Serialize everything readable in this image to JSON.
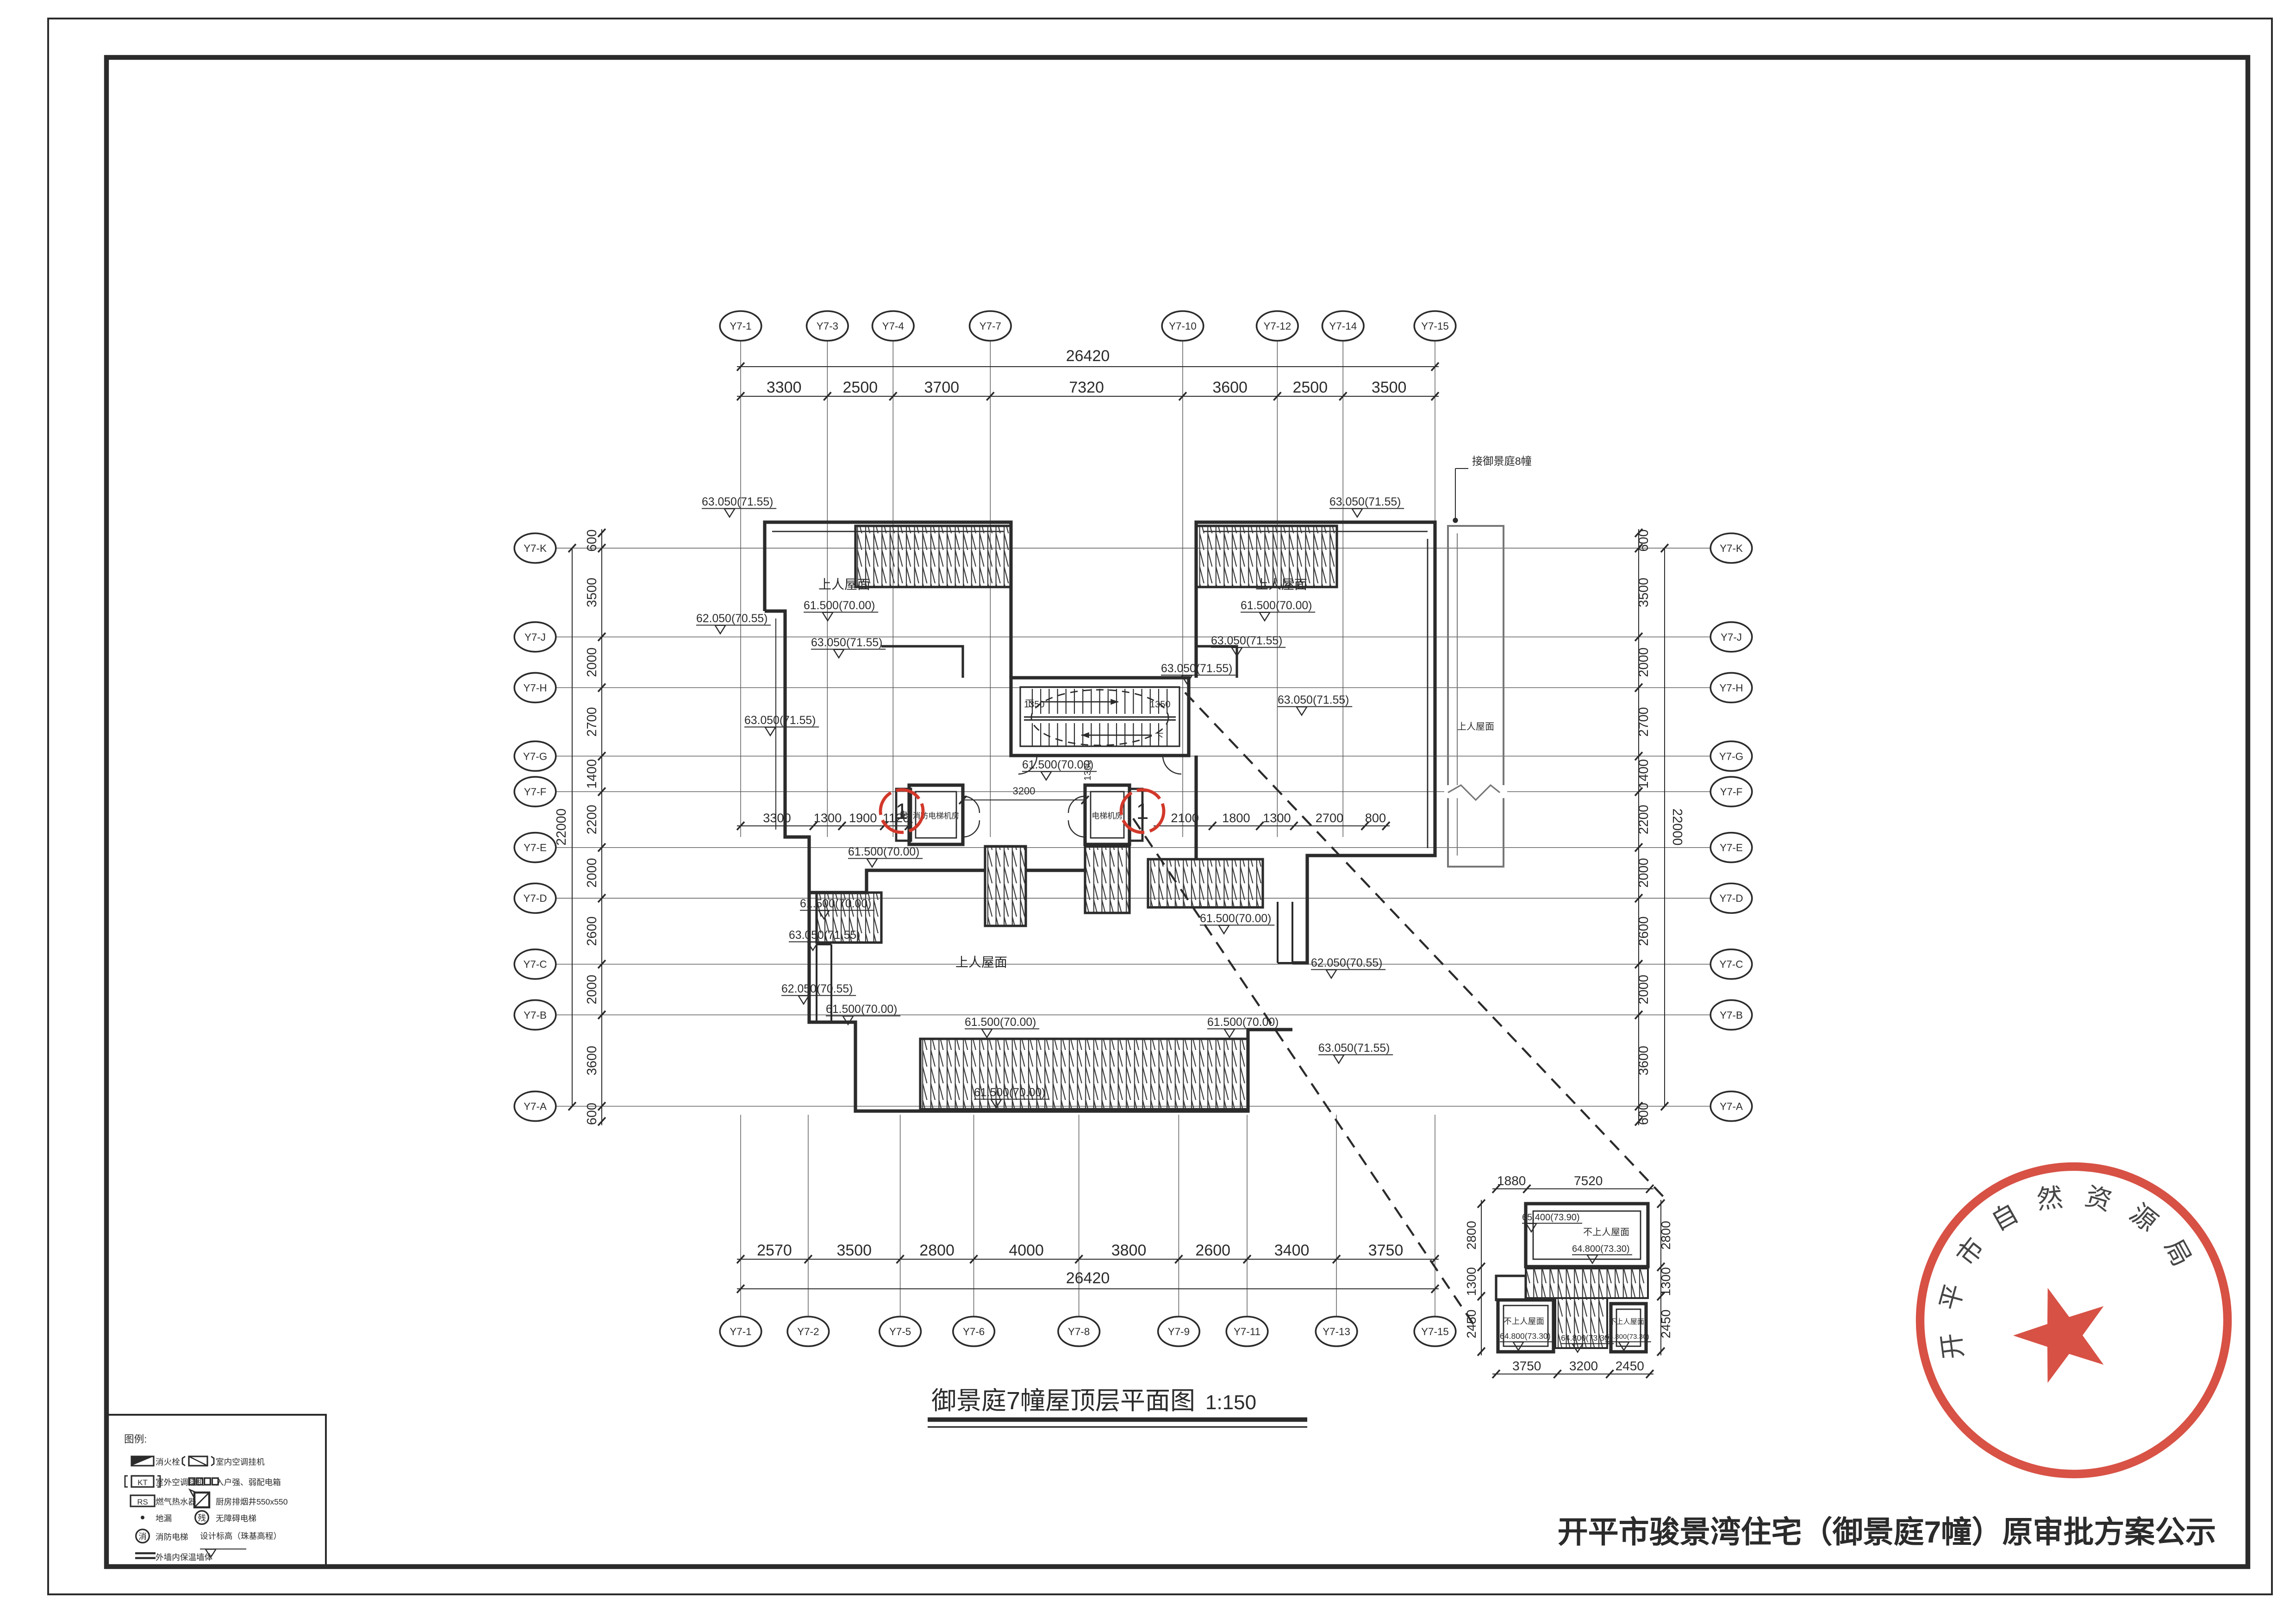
{
  "page": {
    "plan_title": "御景庭7幢屋顶层平面图",
    "plan_scale": "1:150",
    "notice_title": "开平市骏景湾住宅（御景庭7幢）原审批方案公示",
    "stamp_text": "开平市自然资源局",
    "note_adjacent": "接御景庭8幢"
  },
  "colors": {
    "ink": "#2b2b2b",
    "red": "#d2382a",
    "light": "#777777"
  },
  "axes": {
    "top_bubbles": [
      {
        "label": "Y7-1",
        "mm": 0
      },
      {
        "label": "Y7-3",
        "mm": 3300
      },
      {
        "label": "Y7-4",
        "mm": 5800
      },
      {
        "label": "Y7-7",
        "mm": 9500
      },
      {
        "label": "Y7-10",
        "mm": 16820
      },
      {
        "label": "Y7-12",
        "mm": 20420
      },
      {
        "label": "Y7-14",
        "mm": 22920
      },
      {
        "label": "Y7-15",
        "mm": 26420
      }
    ],
    "bottom_bubbles": [
      {
        "label": "Y7-1",
        "mm": 0
      },
      {
        "label": "Y7-2",
        "mm": 2570
      },
      {
        "label": "Y7-5",
        "mm": 6070
      },
      {
        "label": "Y7-6",
        "mm": 8870
      },
      {
        "label": "Y7-8",
        "mm": 12870
      },
      {
        "label": "Y7-9",
        "mm": 16670
      },
      {
        "label": "Y7-11",
        "mm": 19270
      },
      {
        "label": "Y7-13",
        "mm": 22670
      },
      {
        "label": "Y7-15",
        "mm": 26420
      }
    ],
    "side_bubbles": [
      {
        "label": "Y7-K",
        "mm": 0
      },
      {
        "label": "Y7-J",
        "mm": 3500
      },
      {
        "label": "Y7-H",
        "mm": 5500
      },
      {
        "label": "Y7-G",
        "mm": 8200
      },
      {
        "label": "Y7-F",
        "mm": 9600
      },
      {
        "label": "Y7-E",
        "mm": 11800
      },
      {
        "label": "Y7-D",
        "mm": 13800
      },
      {
        "label": "Y7-C",
        "mm": 16400
      },
      {
        "label": "Y7-B",
        "mm": 18400
      },
      {
        "label": "Y7-A",
        "mm": 22000
      }
    ]
  },
  "dimensions": {
    "top_segments": [
      3300,
      2500,
      3700,
      7320,
      3600,
      2500,
      3500
    ],
    "top_total": "26420",
    "bottom_segments": [
      2570,
      3500,
      2800,
      4000,
      3800,
      2600,
      3400,
      3750
    ],
    "bottom_total": "26420",
    "side_segments": [
      3500,
      2000,
      2700,
      1400,
      2200,
      2000,
      2600,
      2000,
      3600
    ],
    "side_total": "22000",
    "eave_offset": "600",
    "mid_left_segments": [
      3300,
      1300,
      1900,
      1120
    ],
    "mid_right_segments": [
      2100,
      1800,
      1300,
      2700,
      800
    ],
    "stair_left_width": "1350",
    "stair_right_width": "1350",
    "stair_depth": "1300",
    "core_gap": "3200",
    "detail_top": [
      1880,
      7520
    ],
    "detail_bottom": [
      3750,
      3200,
      2450
    ],
    "detail_side": [
      2800,
      1300,
      2450
    ]
  },
  "annotations": {
    "roof_access": "上人屋面",
    "roof_no_access": "不上人屋面",
    "lv61": "61.500(70.00)",
    "lv62": "62.050(70.55)",
    "lv63": "63.050(71.55)",
    "lv648": "64.800(73.30)",
    "lv654": "65.400(73.90)",
    "fire_elev_room": "消防电梯机房",
    "elev_room": "电梯机房",
    "down": "下",
    "elec": "电",
    "marker1": "1"
  },
  "legend": {
    "title": "图例:",
    "sym_kt": "KT",
    "sym_rs": "RS",
    "sym_can": "残",
    "sym_xiao": "消",
    "items": [
      {
        "symbol": "hydrant",
        "label": "消火栓"
      },
      {
        "symbol": "ac-indoor",
        "label": "室内空调挂机"
      },
      {
        "symbol": "ac-outdoor",
        "label": "室外空调挂机"
      },
      {
        "symbol": "power-box",
        "label": "入户强、弱配电箱"
      },
      {
        "symbol": "gas-heater",
        "label": "燃气热水器"
      },
      {
        "symbol": "kitchen-shaft",
        "label": "厨房排烟井550x550"
      },
      {
        "symbol": "floor-drain",
        "label": "地漏"
      },
      {
        "symbol": "accessible-elevator",
        "label": "无障碍电梯"
      },
      {
        "symbol": "fire-elevator",
        "label": "消防电梯"
      },
      {
        "symbol": "design-level",
        "label": "设计标高（珠基高程）"
      },
      {
        "symbol": "insulated-wall",
        "label": "外墙内保温墙体"
      }
    ]
  }
}
